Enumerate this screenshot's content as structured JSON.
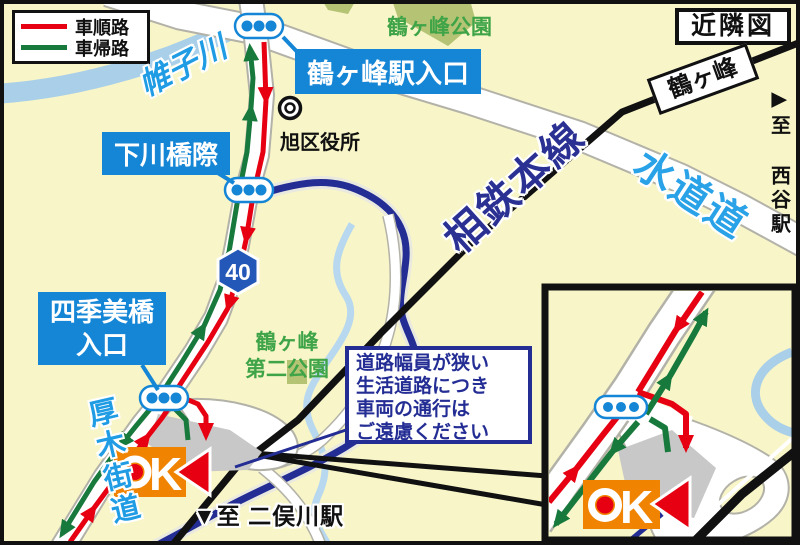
{
  "title_box": {
    "label": "近隣図"
  },
  "legend": {
    "items": [
      {
        "label": "車順路",
        "color": "#e60012"
      },
      {
        "label": "車帰路",
        "color": "#17793c"
      }
    ]
  },
  "intersections": {
    "tsurugamine_station_entrance": "鶴ヶ峰駅入口",
    "shimokawabashi": "下川橋際",
    "shikimibashi_line1": "四季美橋",
    "shikimibashi_line2": "入口"
  },
  "places": {
    "ward_office": "旭区役所",
    "park1": "鶴ヶ峰公園",
    "park2_line1": "鶴ヶ峰",
    "park2_line2": "第二公園"
  },
  "waterways": {
    "katabira_river": "帷子川"
  },
  "roads": {
    "suidomichi": "水道道",
    "atsugi_kaido": "厚木街道",
    "route_number": "40"
  },
  "railway": {
    "line_name": "相鉄本線",
    "station_name": "鶴ヶ峰"
  },
  "directions": {
    "nishiya_arrow": "▶",
    "nishiya_label": "至 西谷駅",
    "futamatagawa_label": "▼至 二俣川駅"
  },
  "notice": {
    "line1": "道路幅員が狭い",
    "line2": "生活道路につき",
    "line3": "車両の通行は",
    "line4": "ご遠慮ください"
  },
  "store": {
    "brand": "OK",
    "k_letter": "K"
  },
  "colors": {
    "background": "#f8f5c8",
    "route_red": "#e60012",
    "route_return_green": "#17793c",
    "label_blue": "#1586d6",
    "navy": "#232d94",
    "river_light_blue": "#a9cfe9",
    "road_text_blue": "#1f9ce4",
    "park_green_fill": "#b5c374",
    "park_green_text": "#3ea447",
    "railway_black": "#111111",
    "ok_orange": "#f08300",
    "route_badge_blue": "#2458b8"
  }
}
